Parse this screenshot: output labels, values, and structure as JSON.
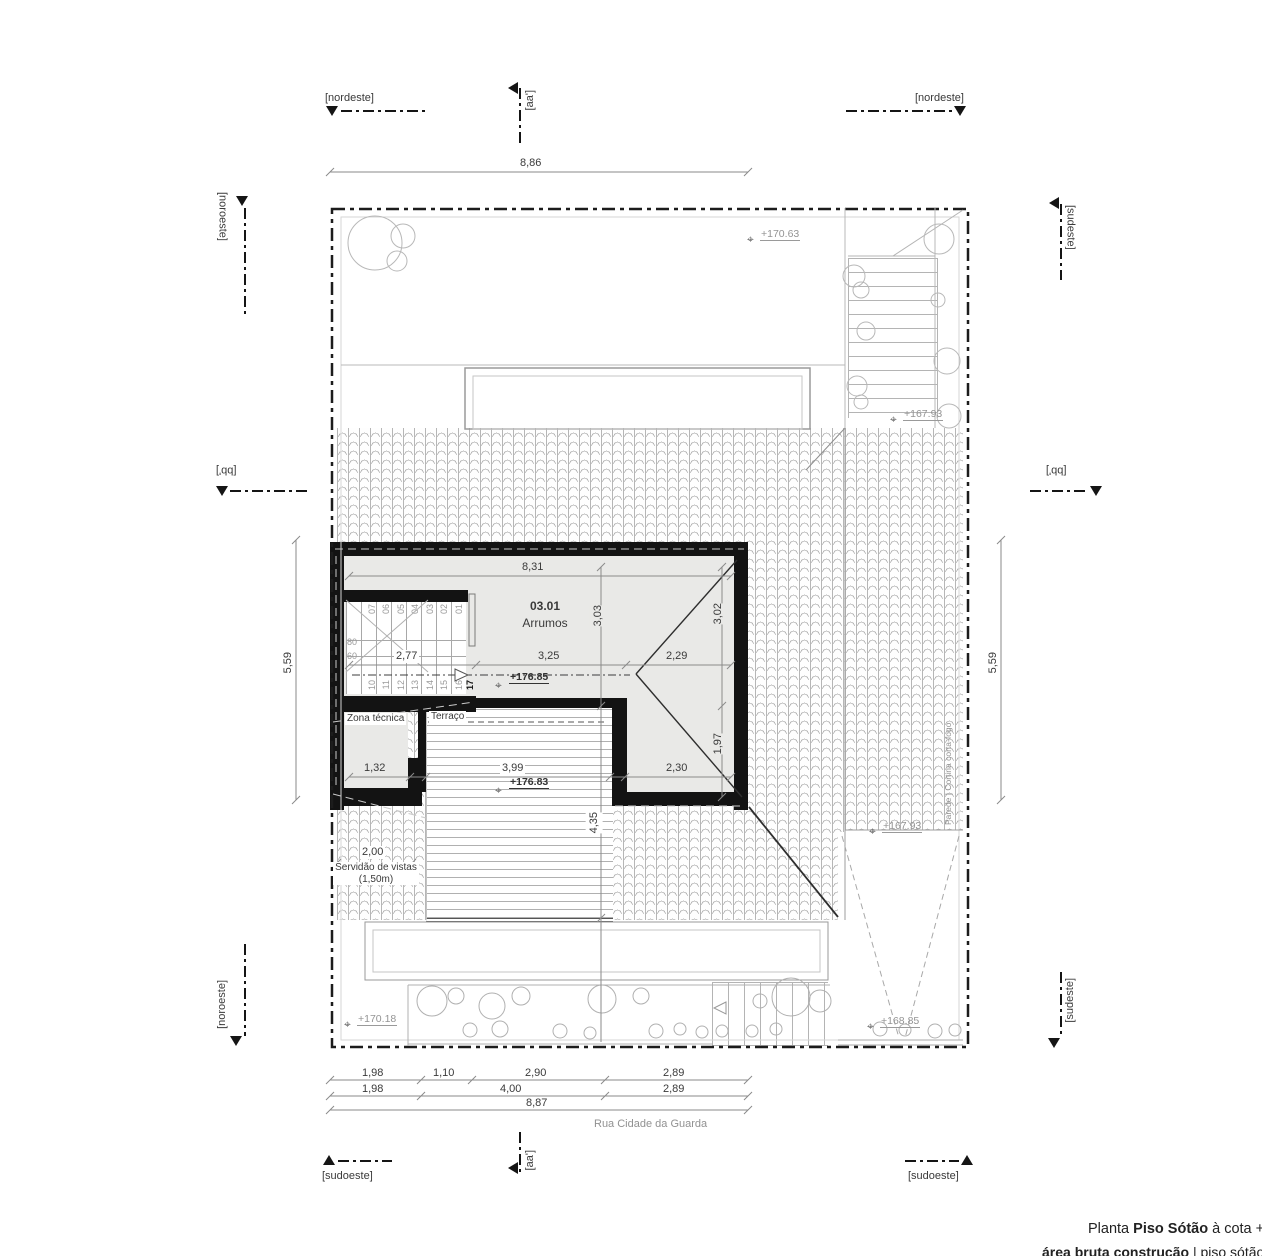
{
  "title": {
    "prefix": "Planta ",
    "name": "Piso Sótão",
    "suffix": " à cota +178",
    "line2_bold": "área bruta construção",
    "line2_rest": " | piso sótão = 03"
  },
  "street": "Rua Cidade da Guarda",
  "markers": {
    "nordeste": "[nordeste]",
    "noroeste": "[noroeste]",
    "sudeste": "[sudeste]",
    "sudoeste": "[sudoeste]",
    "aa": "[aa']",
    "bb": "[bb']"
  },
  "rooms": {
    "main_id": "03.01",
    "main_name": "Arrumos",
    "zona": "Zona técnica",
    "terraco": "Terraço",
    "servidao_l1": "Servidão de vistas",
    "servidao_l2": "(1,50m)",
    "firewall": "Parede | Cortina corta-fogo"
  },
  "levels": {
    "l17063": "+170.63",
    "l16793": "+167.93",
    "l17685": "+176.85",
    "l17683": "+176.83",
    "l16885": "+168.85",
    "l17018": "+170.18"
  },
  "dims": {
    "top": "8,86",
    "room_w": "8,31",
    "row_mid": [
      "2,77",
      "3,25",
      "2,29"
    ],
    "row_low": [
      "1,32",
      "3,99",
      "2,30"
    ],
    "v303": "3,03",
    "v302": "3,02",
    "v197": "1,97",
    "v435": "4,35",
    "v559": "5,59",
    "serv": "2,00",
    "b1": [
      "1,98",
      "1,10",
      "2,90",
      "2,89"
    ],
    "b2": [
      "1,98",
      "4,00",
      "2,89"
    ],
    "b3": "8,87"
  },
  "stairs": {
    "upper": [
      "01",
      "02",
      "03",
      "04",
      "05",
      "06",
      "07"
    ],
    "lower": [
      "10",
      "11",
      "12",
      "13",
      "14",
      "15",
      "16",
      "17"
    ],
    "rise": "80",
    "going": "60"
  }
}
